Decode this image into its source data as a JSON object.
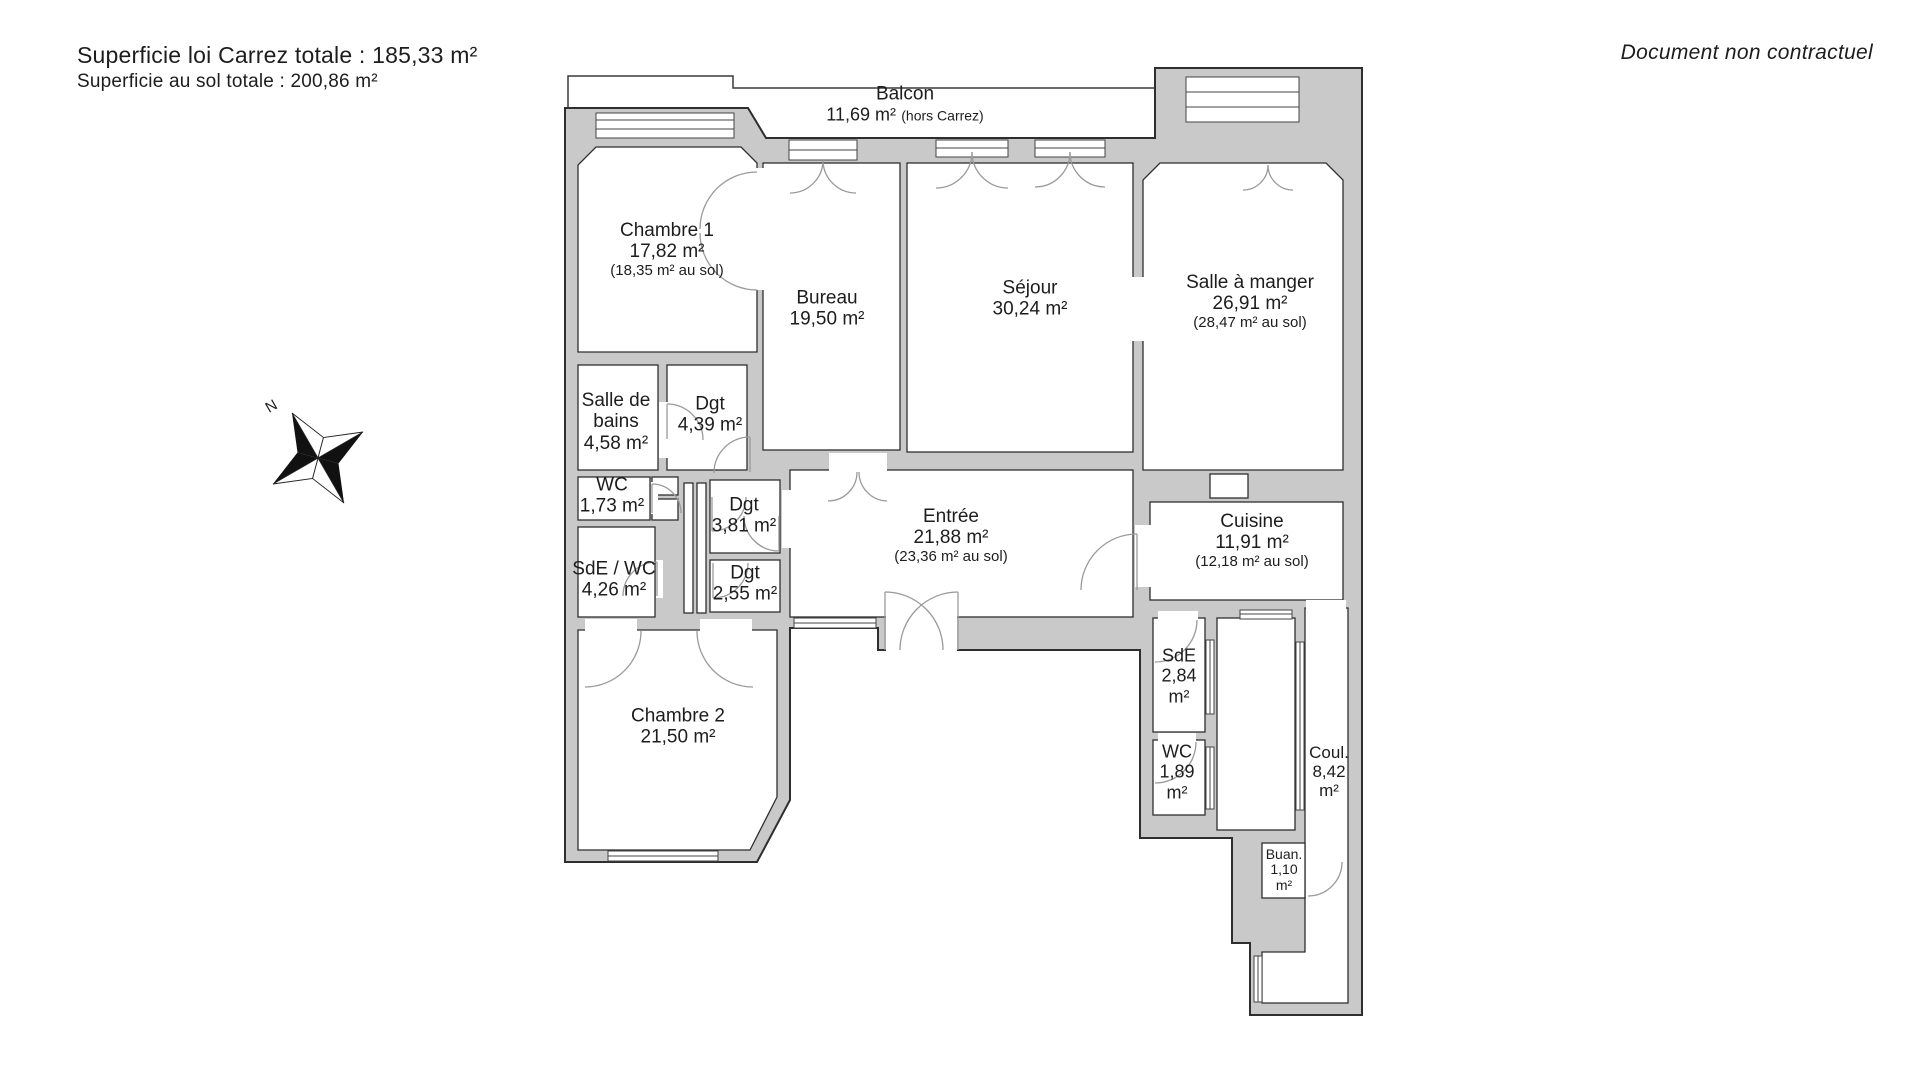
{
  "header": {
    "carrez_total": "Superficie loi Carrez totale :  185,33 m²",
    "floor_total": "Superficie au sol totale :  200,86 m²"
  },
  "disclaimer": "Document non contractuel",
  "compass": {
    "north_label": "N"
  },
  "rooms": {
    "balcon": {
      "name": "Balcon",
      "area": "11,69 m²",
      "note": "(hors Carrez)"
    },
    "chambre1": {
      "name": "Chambre 1",
      "area": "17,82 m²",
      "floor": "(18,35 m² au sol)"
    },
    "bureau": {
      "name": "Bureau",
      "area": "19,50 m²"
    },
    "sejour": {
      "name": "Séjour",
      "area": "30,24 m²"
    },
    "salle_a_manger": {
      "name": "Salle à manger",
      "area": "26,91 m²",
      "floor": "(28,47 m² au sol)"
    },
    "salle_de_bains": {
      "name": "Salle de bains",
      "area": "4,58 m²"
    },
    "dgt_1": {
      "name": "Dgt",
      "area": "4,39 m²"
    },
    "wc_1": {
      "name": "WC",
      "area": "1,73 m²"
    },
    "sde_wc": {
      "name": "SdE / WC",
      "area": "4,26 m²"
    },
    "dgt_2": {
      "name": "Dgt",
      "area": "3,81 m²"
    },
    "dgt_3": {
      "name": "Dgt",
      "area": "2,55 m²"
    },
    "entree": {
      "name": "Entrée",
      "area": "21,88 m²",
      "floor": "(23,36 m² au sol)"
    },
    "cuisine": {
      "name": "Cuisine",
      "area": "11,91 m²",
      "floor": "(12,18 m² au sol)"
    },
    "chambre2": {
      "name": "Chambre 2",
      "area": "21,50 m²"
    },
    "sde_2": {
      "name": "SdE",
      "area": "2,84 m²"
    },
    "wc_2": {
      "name": "WC",
      "area": "1,89 m²"
    },
    "couloir": {
      "name": "Coul.",
      "area": "8,42 m²"
    },
    "buanderie": {
      "name": "Buan.",
      "area": "1,10 m²"
    }
  },
  "colors": {
    "wall_fill": "#c9c9c9",
    "outline": "#2e2e2e",
    "door_arc": "#9a9a9a",
    "text": "#1d1d1d"
  }
}
